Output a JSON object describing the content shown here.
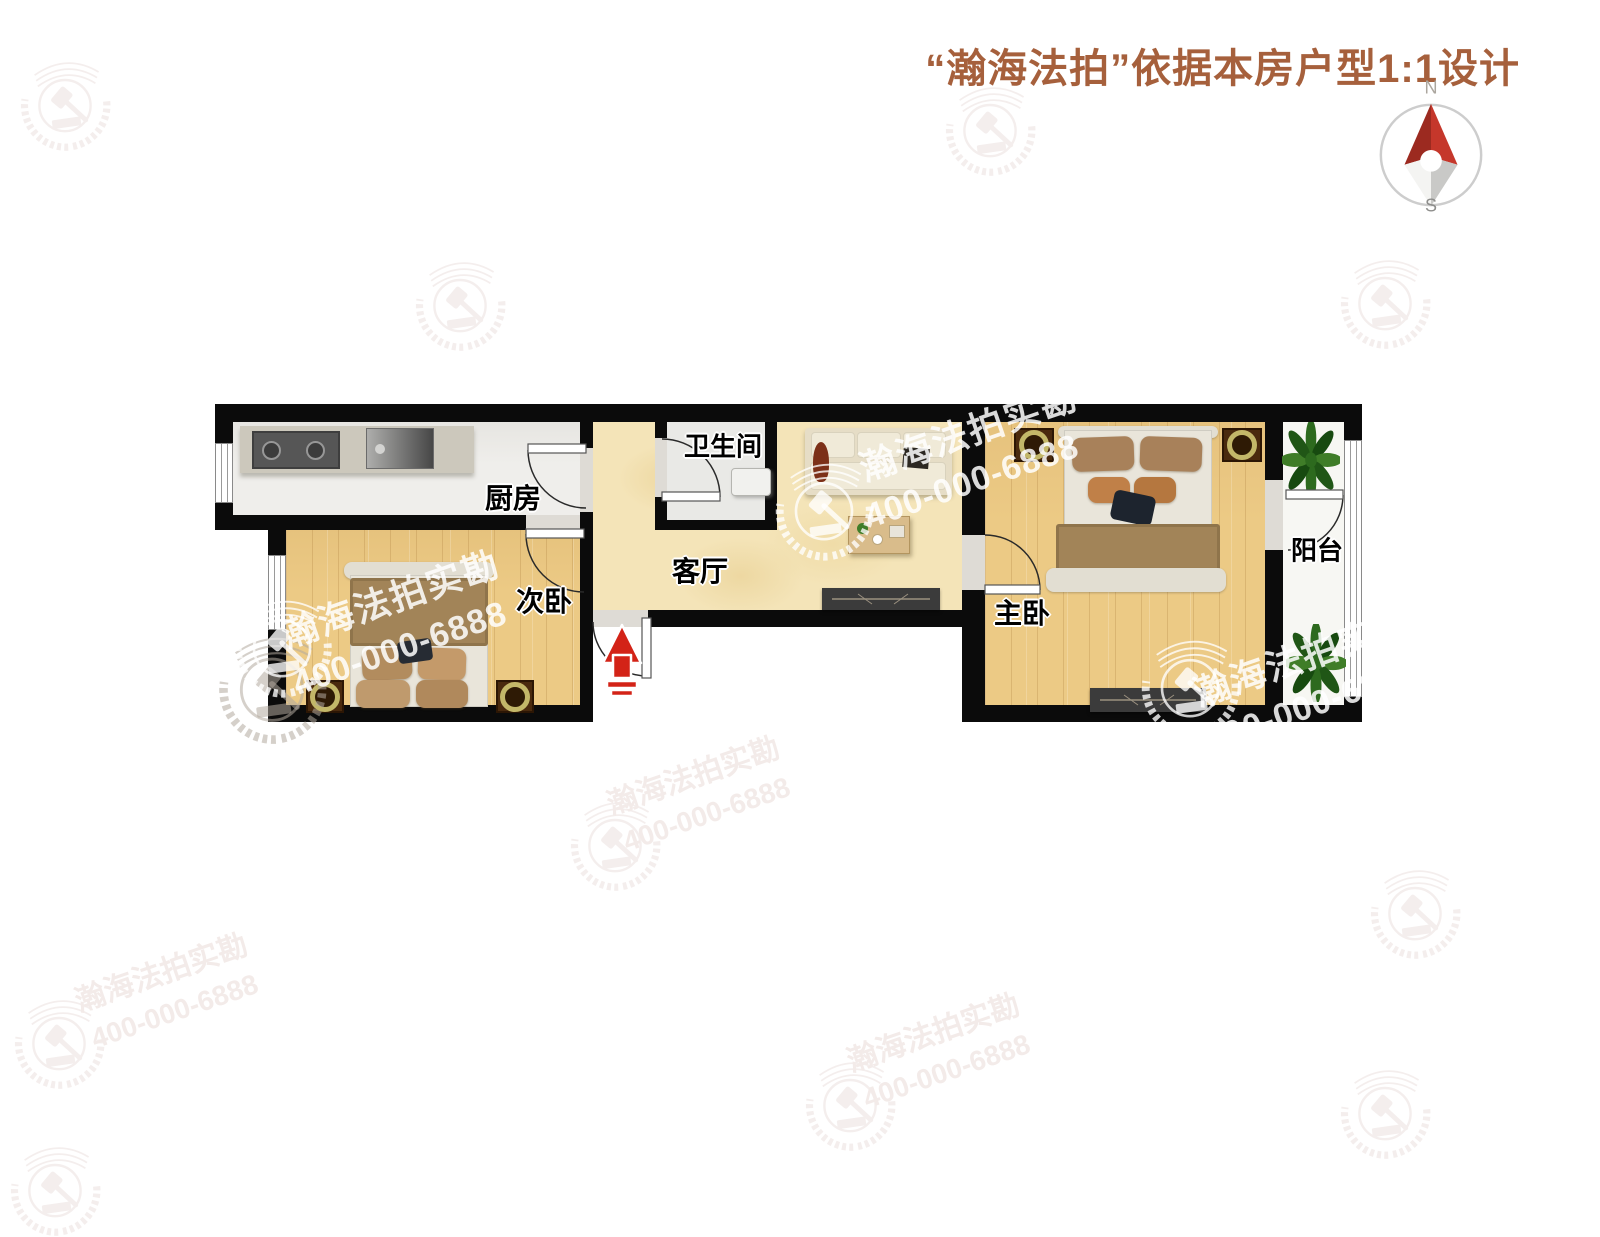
{
  "header": {
    "title": "“瀚海法拍”依据本房户型1:1设计"
  },
  "compass": {
    "north": "N",
    "south": "S"
  },
  "rooms": {
    "kitchen": "厨房",
    "bathroom": "卫生间",
    "living_room": "客厅",
    "second_bedroom": "次卧",
    "master_bedroom": "主卧",
    "balcony": "阳台"
  },
  "watermark": {
    "brand": "瀚海法拍实勘",
    "phone": "400-000-6888"
  },
  "colors": {
    "title_text": "#a6603c",
    "wall": "#0b0b0b",
    "wood_floor": "#ecca85",
    "marble_floor": "#f4e4b8",
    "kitchen_floor": "#efeeeb",
    "entrance_arrow_red": "#d32317",
    "compass_needle_red": "#c5372b",
    "watermark_white": "rgba(255,255,255,0.85)"
  }
}
